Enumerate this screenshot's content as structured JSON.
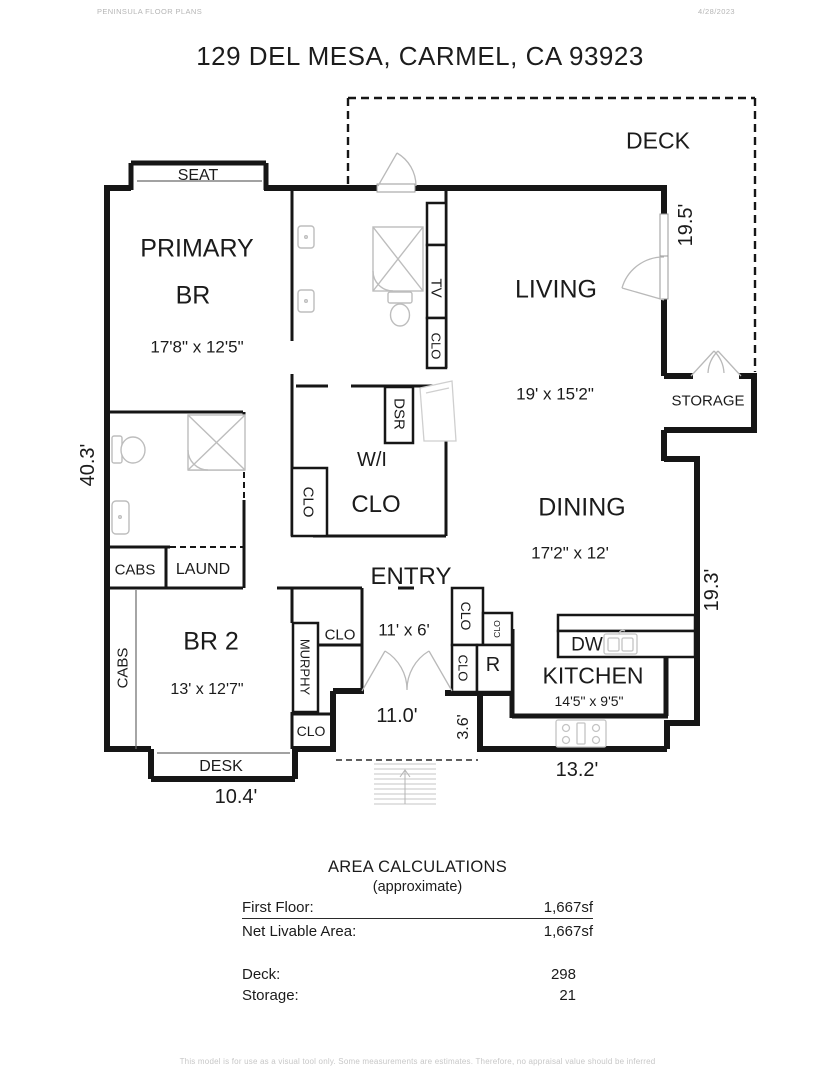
{
  "header": {
    "brand": "PENINSULA FLOOR PLANS",
    "date": "4/28/2023",
    "title": "129 DEL MESA, CARMEL, CA  93923"
  },
  "rooms": {
    "deck": {
      "name": "DECK"
    },
    "living": {
      "name": "LIVING",
      "dims": "19' x 15'2\""
    },
    "primary": {
      "line1": "PRIMARY",
      "line2": "BR",
      "dims": "17'8\" x 12'5\""
    },
    "dining": {
      "name": "DINING",
      "dims": "17'2\" x 12'"
    },
    "kitchen": {
      "name": "KITCHEN",
      "dims": "14'5\" x 9'5\""
    },
    "entry": {
      "name": "ENTRY",
      "dims": "11' x 6'"
    },
    "br2": {
      "name": "BR 2",
      "dims": "13' x 12'7\""
    },
    "wi_clo": {
      "line1": "W/I",
      "line2": "CLO"
    },
    "storage": {
      "name": "STORAGE"
    },
    "laundry": {
      "name": "LAUND"
    }
  },
  "fixtures": {
    "seat": "SEAT",
    "desk": "DESK",
    "cabs": "CABS",
    "clo": "CLO",
    "tv": "TV",
    "dsr": "DSR",
    "murphy": "MURPHY",
    "dw": "DW",
    "fridge": "R"
  },
  "dims": {
    "left_side": "40.3'",
    "deck_side": "19.5'",
    "dining_side": "19.3'",
    "porch_width": "11.0'",
    "porch_depth": "3.6'",
    "kitchen_width": "13.2'",
    "desk_width": "10.4'"
  },
  "area": {
    "title": "AREA CALCULATIONS",
    "subtitle": "(approximate)",
    "rows": [
      {
        "label": "First  Floor:",
        "value": "1,667sf"
      },
      {
        "label": "Net Livable Area:",
        "value": "1,667sf"
      }
    ],
    "extra": [
      {
        "label": "Deck:",
        "value": "298"
      },
      {
        "label": "Storage:",
        "value": "21"
      }
    ]
  },
  "footer": {
    "disclaimer": "This model is for use as a visual tool only. Some measurements are estimates. Therefore, no appraisal value should be inferred"
  },
  "colors": {
    "wall": "#161616",
    "fixture": "#bdbdbd",
    "accent_text": "#1b1b1b"
  }
}
